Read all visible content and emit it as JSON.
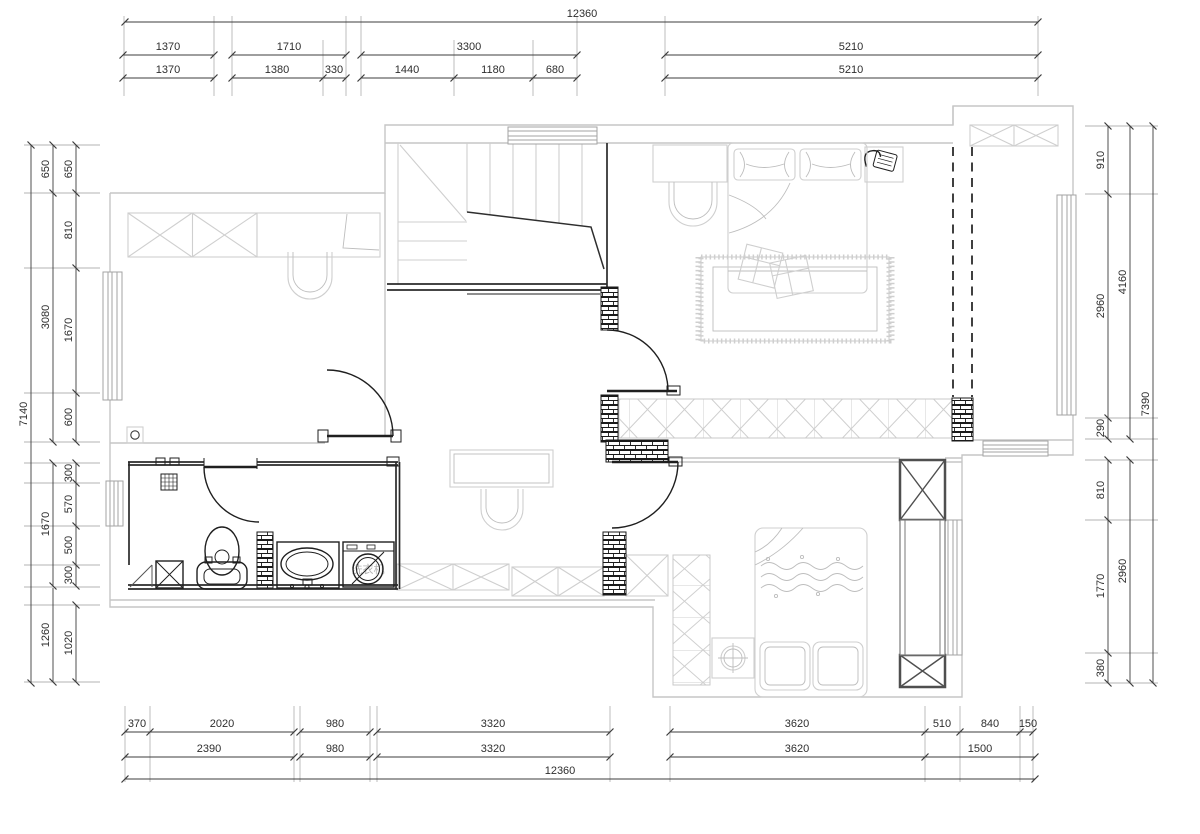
{
  "drawing": {
    "kind": "floor-plan"
  },
  "labels": {
    "washing_machine": "洗衣机"
  },
  "colors": {
    "background": "#ffffff",
    "wall_light": "#c6c6c6",
    "furniture": "#cfcfcf",
    "fixture_dark": "#1f1f1f",
    "dimension_line": "#3c3c3c",
    "dimension_text": "#2e2e2e",
    "column_dark": "#4f4f4f"
  },
  "dims": {
    "top": {
      "total": "12360",
      "row2": [
        "1370",
        "1710",
        "3300",
        "5210"
      ],
      "row3": [
        "1370",
        "1380",
        "330",
        "1440",
        "1180",
        "680",
        "5210"
      ]
    },
    "bottom": {
      "row1": [
        "370",
        "2020",
        "980",
        "3320",
        "3620",
        "510",
        "840",
        "150"
      ],
      "row2": [
        "2390",
        "980",
        "3320",
        "3620",
        "1500"
      ],
      "total": "12360"
    },
    "left": {
      "total": "7140",
      "mid": [
        "650",
        "3080",
        "1670",
        "1260"
      ],
      "inner": [
        "650",
        "810",
        "1670",
        "600",
        "300",
        "570",
        "500",
        "300",
        "1020"
      ]
    },
    "right": {
      "total": "7390",
      "mid": [
        "4160",
        "2960"
      ],
      "inner": [
        "910",
        "2960",
        "290",
        "810",
        "1770",
        "380"
      ]
    }
  }
}
